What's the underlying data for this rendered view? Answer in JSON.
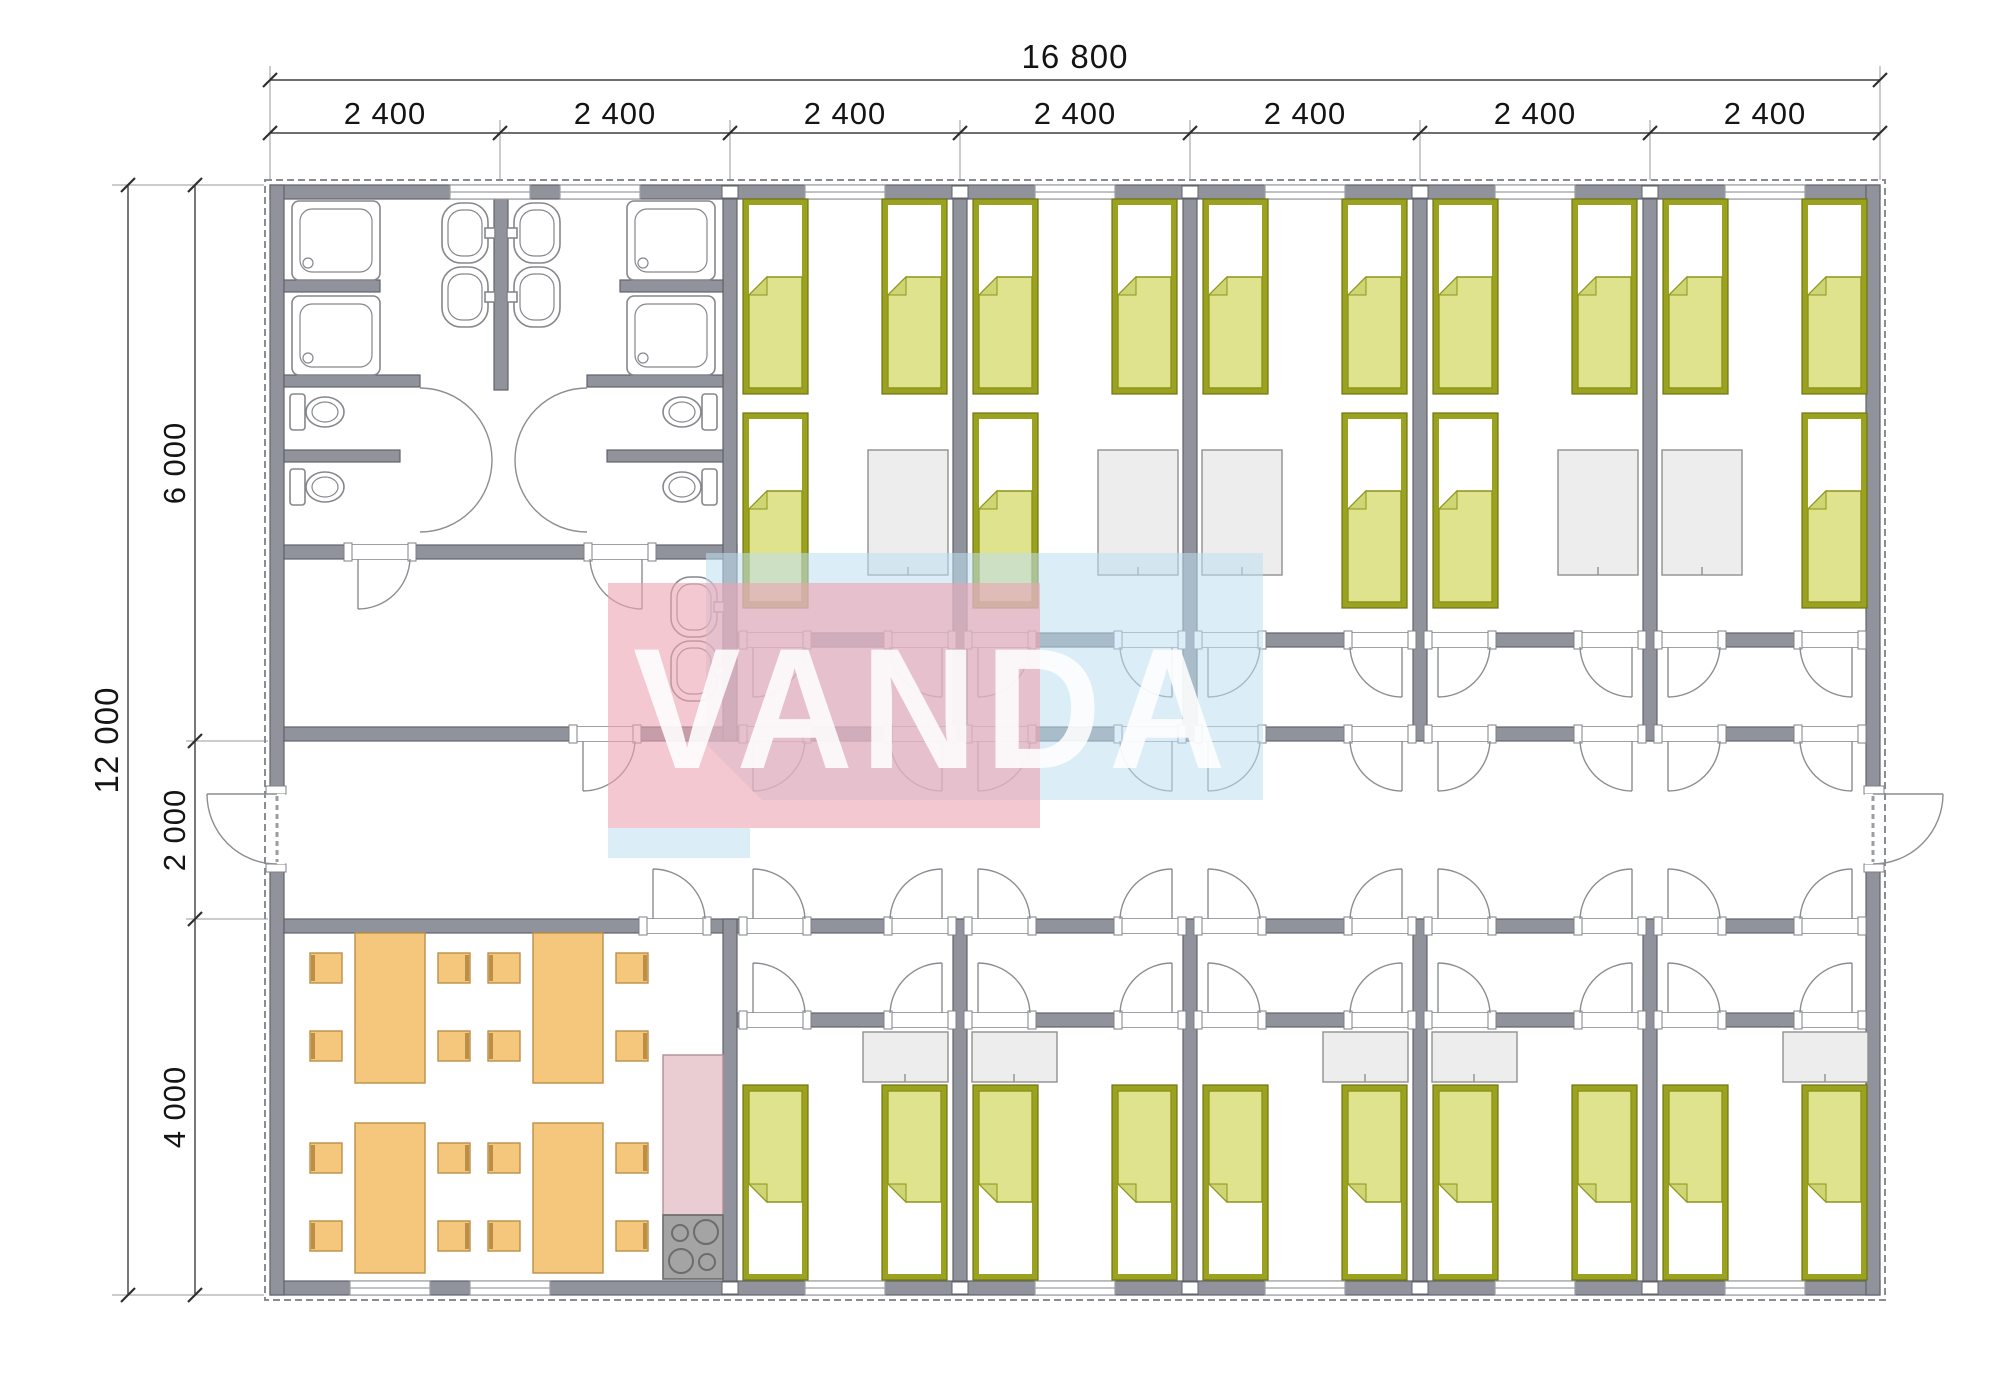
{
  "watermark": {
    "text": "VANDA"
  },
  "dimensions": {
    "overall_width": "16 800",
    "modules": [
      "2 400",
      "2 400",
      "2 400",
      "2 400",
      "2 400",
      "2 400",
      "2 400"
    ],
    "overall_height": "12 000",
    "height_segments": [
      "6 000",
      "2 000",
      "4 000"
    ]
  },
  "fixtures": {
    "beds": 25,
    "showers": 4,
    "toilets": 4,
    "sinks": 6,
    "dining_tables": 4,
    "chairs": 16,
    "wardrobes": 10,
    "stoves": 1,
    "kitchen_counters": 1,
    "entrance_doors": 2
  },
  "colors": {
    "wall": "#90939b",
    "wall_stroke": "#60636a",
    "hatch": "#8a8d94",
    "bed_frame": "#9aa21f",
    "bed_frame_stroke": "#70760f",
    "bed_fill": "#dfe38d",
    "bed_fill_stroke": "#8e941c",
    "bed_fold": "#ced573",
    "wardrobe": "#ededed",
    "wardrobe_stroke": "#909090",
    "orange": "#f4c77c",
    "orange_stroke": "#bb8f47",
    "pink": "#e9cdd2",
    "pink_stroke": "#b18f95",
    "stove": "#a4a4a4",
    "stove_stroke": "#6c6c6c",
    "fixture": "#85878c",
    "window_line": "#9b9ea5",
    "dim": "#3f3f3f",
    "text": "#141414",
    "wm_pink": "#eca4b1",
    "wm_blue": "#bedff1",
    "wm_text": "#ffffff"
  }
}
